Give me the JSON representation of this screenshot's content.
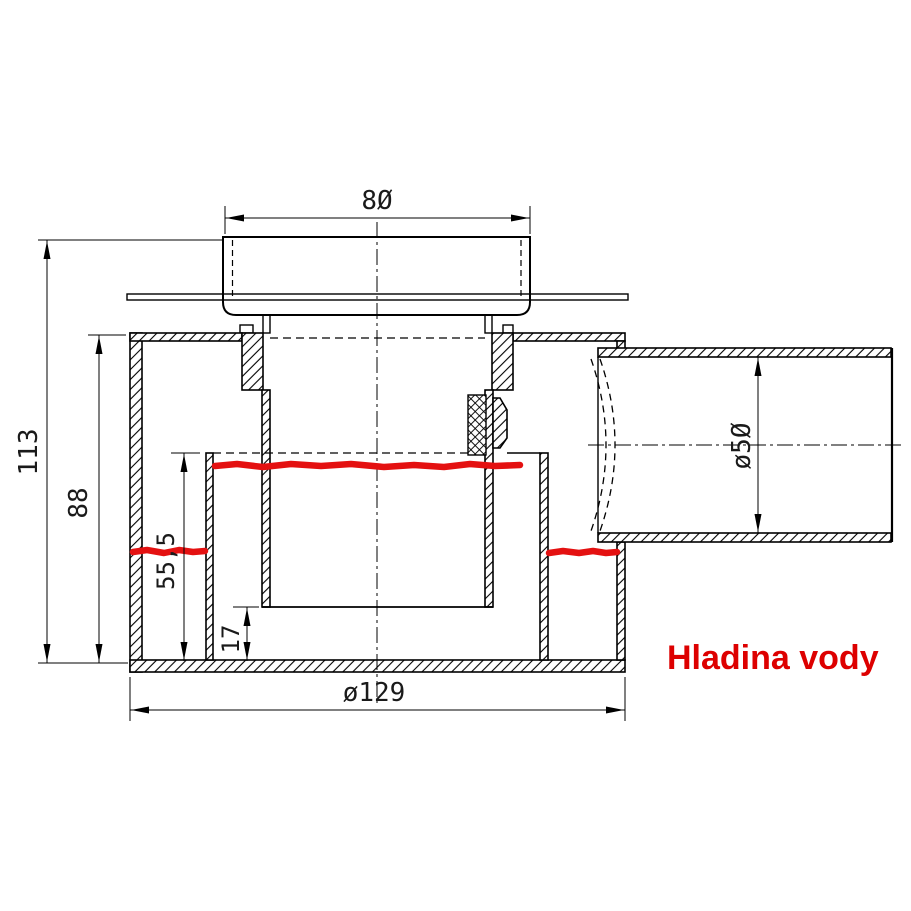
{
  "dimensions": {
    "grate_width": "8Ø",
    "total_height": "113",
    "body_height": "88",
    "water_depth": "55,5",
    "sump_depth": "17",
    "flange_diameter": "ø129",
    "outlet_diameter": "ø5Ø"
  },
  "labels": {
    "water_level": "Hladina vody"
  },
  "colors": {
    "line": "#000000",
    "water_line": "#e41111",
    "water_label": "#dd0000",
    "background": "#ffffff"
  }
}
